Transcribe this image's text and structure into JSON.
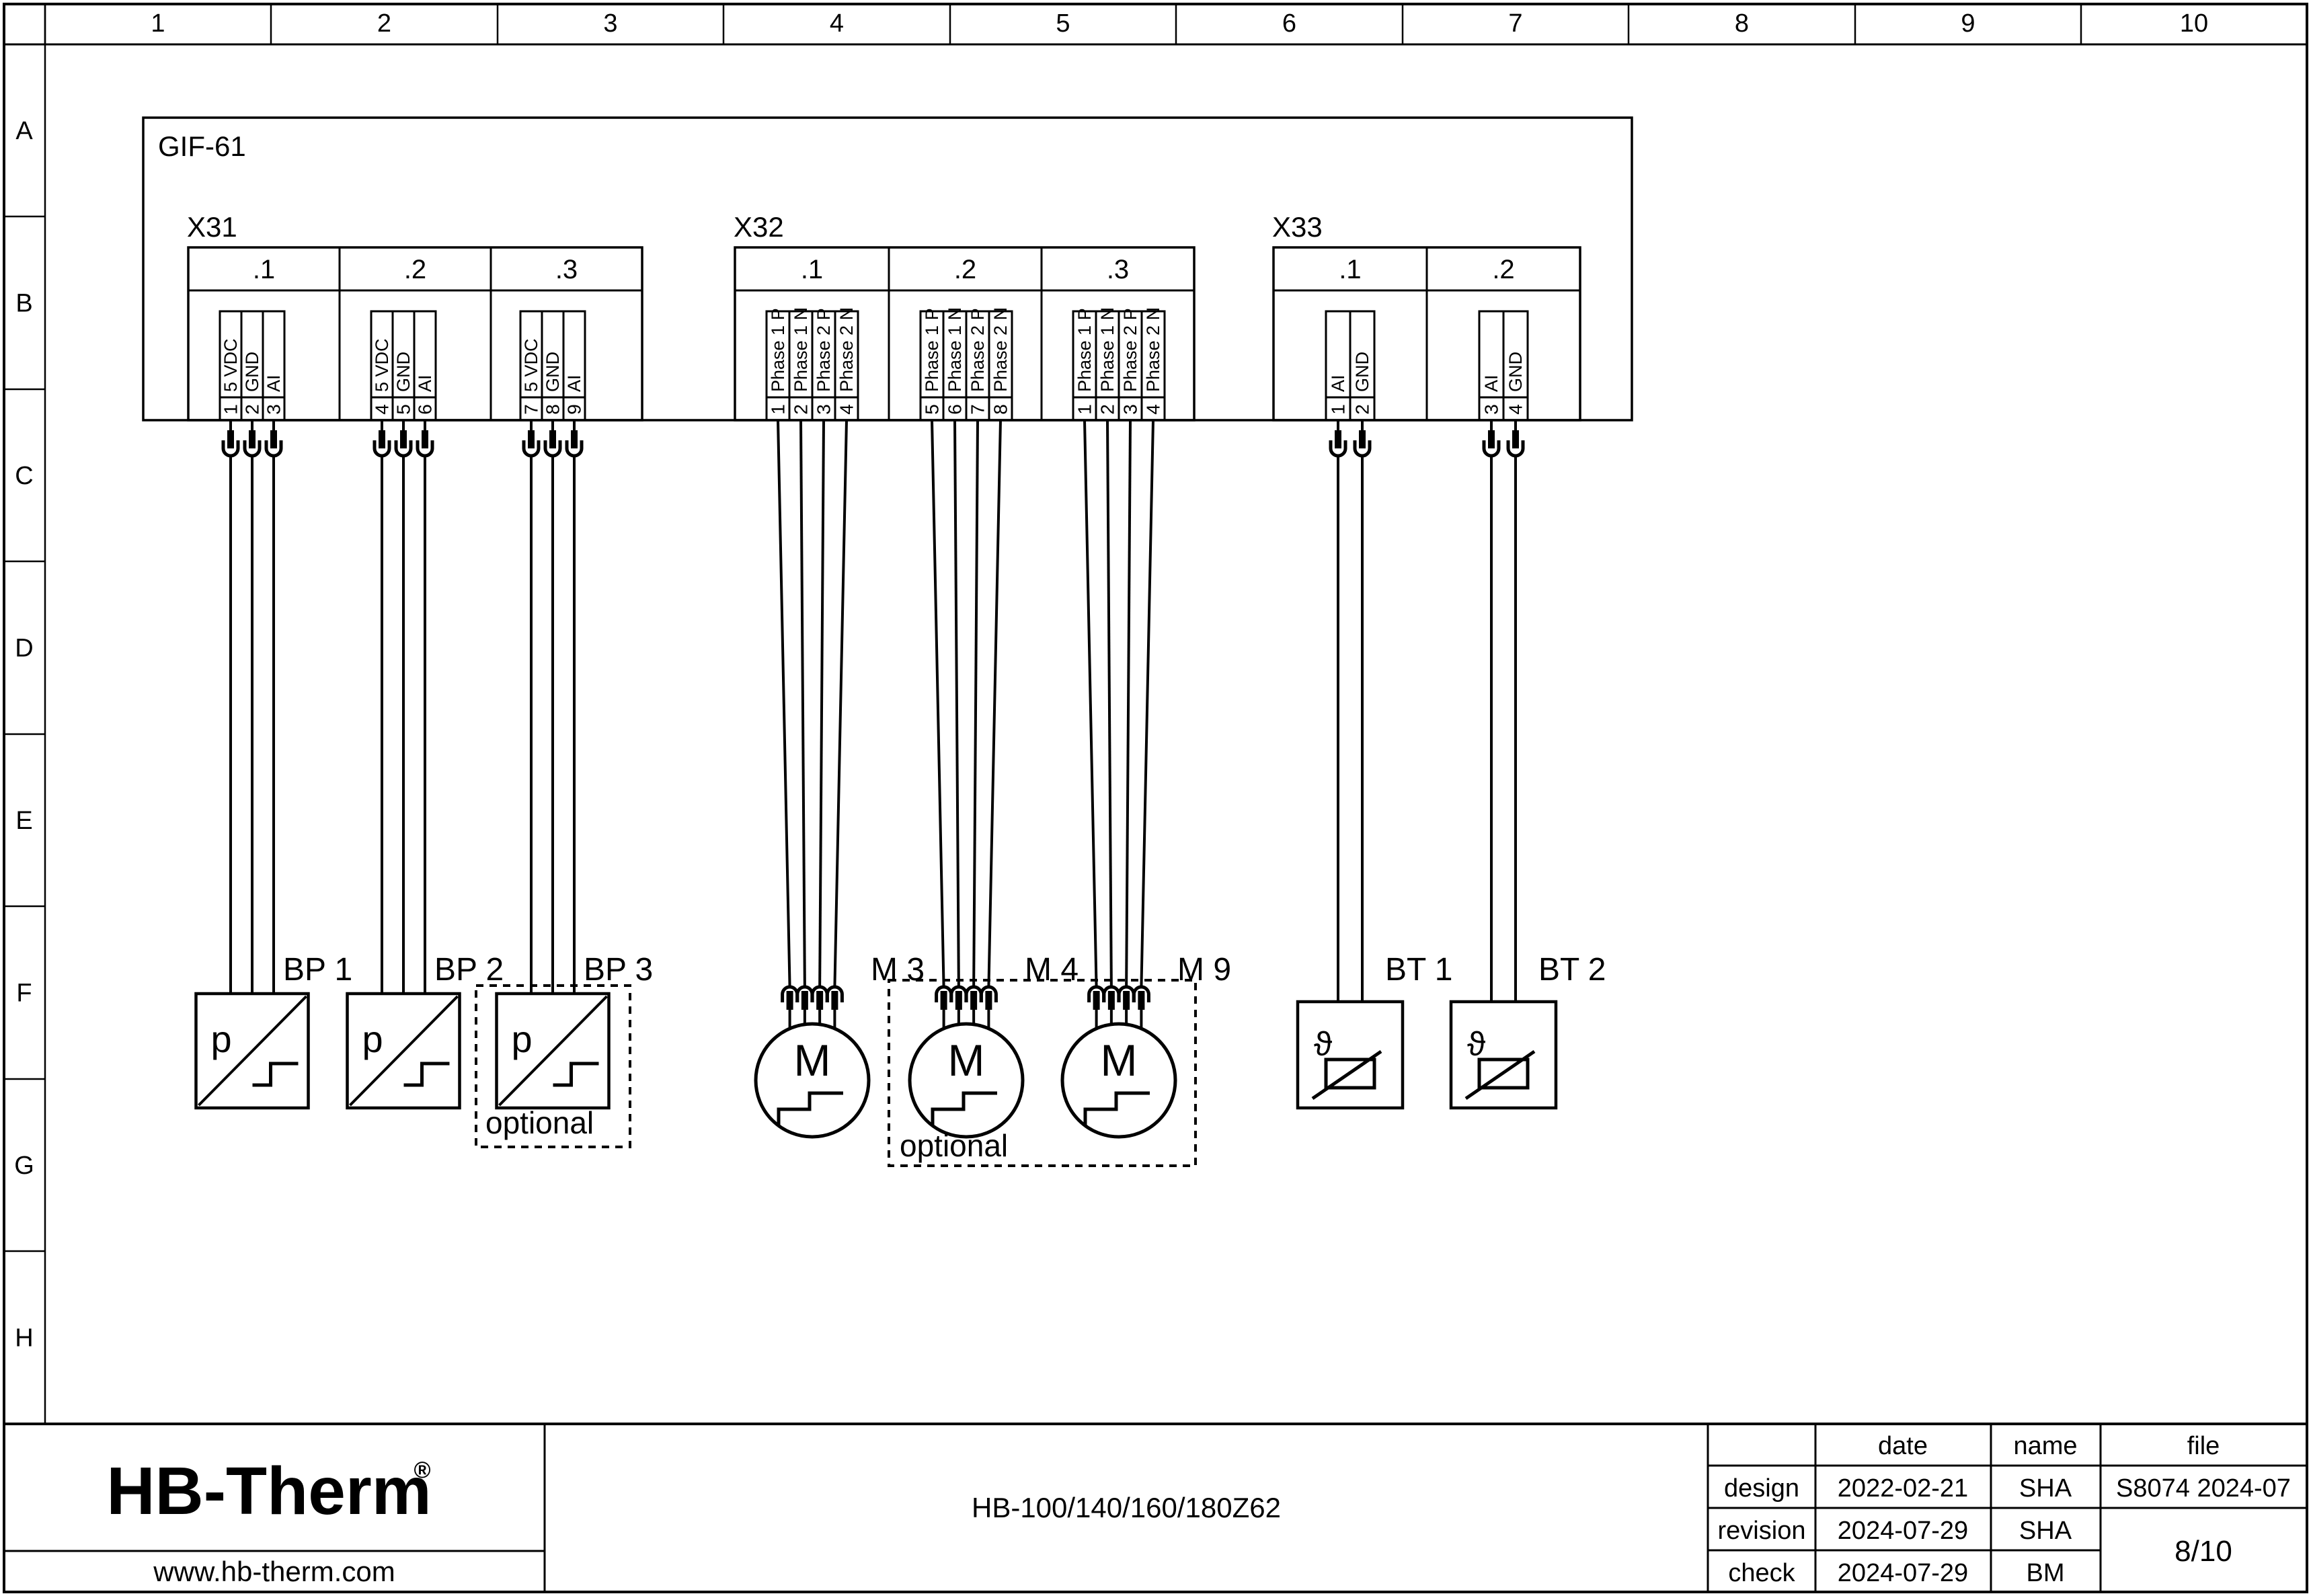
{
  "ruler": {
    "columns": [
      "1",
      "2",
      "3",
      "4",
      "5",
      "6",
      "7",
      "8",
      "9",
      "10"
    ],
    "rows": [
      "A",
      "B",
      "C",
      "D",
      "E",
      "F",
      "G",
      "H"
    ]
  },
  "module": {
    "label": "GIF-61"
  },
  "connector_groups": [
    {
      "label": "X31",
      "subconnectors": [
        {
          "label": ".1",
          "pins": [
            {
              "number": "1",
              "name": "5 VDC"
            },
            {
              "number": "2",
              "name": "GND"
            },
            {
              "number": "3",
              "name": "AI"
            }
          ]
        },
        {
          "label": ".2",
          "pins": [
            {
              "number": "4",
              "name": "5 VDC"
            },
            {
              "number": "5",
              "name": "GND"
            },
            {
              "number": "6",
              "name": "AI"
            }
          ]
        },
        {
          "label": ".3",
          "pins": [
            {
              "number": "7",
              "name": "5 VDC"
            },
            {
              "number": "8",
              "name": "GND"
            },
            {
              "number": "9",
              "name": "AI"
            }
          ]
        }
      ]
    },
    {
      "label": "X32",
      "subconnectors": [
        {
          "label": ".1",
          "pins": [
            {
              "number": "1",
              "name": "Phase 1 P"
            },
            {
              "number": "2",
              "name": "Phase 1 N"
            },
            {
              "number": "3",
              "name": "Phase 2 P"
            },
            {
              "number": "4",
              "name": "Phase 2 N"
            }
          ]
        },
        {
          "label": ".2",
          "pins": [
            {
              "number": "5",
              "name": "Phase 1 P"
            },
            {
              "number": "6",
              "name": "Phase 1 N"
            },
            {
              "number": "7",
              "name": "Phase 2 P"
            },
            {
              "number": "8",
              "name": "Phase 2 N"
            }
          ]
        },
        {
          "label": ".3",
          "pins": [
            {
              "number": "1",
              "name": "Phase 1 P"
            },
            {
              "number": "2",
              "name": "Phase 1 N"
            },
            {
              "number": "3",
              "name": "Phase 2 P"
            },
            {
              "number": "4",
              "name": "Phase 2 N"
            }
          ]
        }
      ]
    },
    {
      "label": "X33",
      "subconnectors": [
        {
          "label": ".1",
          "pins": [
            {
              "number": "1",
              "name": "AI"
            },
            {
              "number": "2",
              "name": "GND"
            }
          ]
        },
        {
          "label": ".2",
          "pins": [
            {
              "number": "3",
              "name": "AI"
            },
            {
              "number": "4",
              "name": "GND"
            }
          ]
        }
      ]
    }
  ],
  "devices": {
    "pressure_sensors": [
      {
        "label": "BP 1",
        "optional": false
      },
      {
        "label": "BP 2",
        "optional": false
      },
      {
        "label": "BP 3",
        "optional": true
      }
    ],
    "motors": [
      {
        "label": "M 3",
        "optional": false
      },
      {
        "label": "M 4",
        "optional": true
      },
      {
        "label": "M 9",
        "optional": true
      }
    ],
    "temperature_sensors": [
      {
        "label": "BT 1"
      },
      {
        "label": "BT 2"
      }
    ],
    "pressure_symbol": "p",
    "motor_symbol": "M",
    "temperature_symbol": "ϑ",
    "optional_label": "optional"
  },
  "title_block": {
    "logo": {
      "text": "HB-Therm",
      "registered": "®",
      "color": "#1f2a4e"
    },
    "website": "www.hb-therm.com",
    "drawing_title": "HB-100/140/160/180Z62",
    "table": {
      "col_headers": [
        "date",
        "name",
        "file"
      ],
      "rows": [
        {
          "label": "design",
          "date": "2022-02-21",
          "name": "SHA"
        },
        {
          "label": "revision",
          "date": "2024-07-29",
          "name": "SHA"
        },
        {
          "label": "check",
          "date": "2024-07-29",
          "name": "BM"
        }
      ],
      "file_number": "S8074 2024-07",
      "sheet": "8/10"
    }
  }
}
